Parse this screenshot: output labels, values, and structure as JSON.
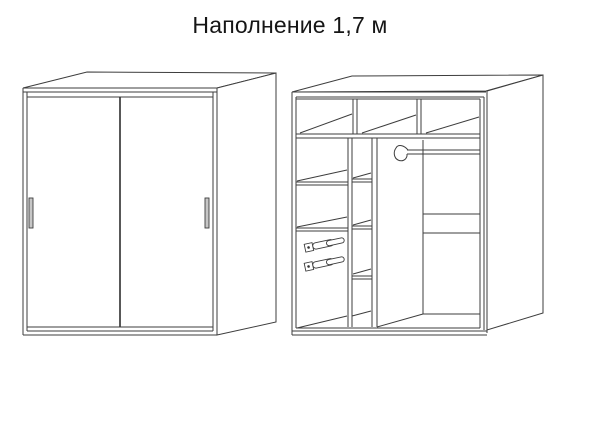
{
  "page": {
    "background": "#ffffff",
    "line_color": "#3d3d3d",
    "width": 600,
    "height": 422
  },
  "title": {
    "text": "Наполнение 1,7 м"
  },
  "diagram": {
    "type": "furniture-scheme",
    "views": [
      {
        "id": "closed-view",
        "name": "wardrobe-closed-view",
        "parts": [
          "top-panel",
          "right-side-panel",
          "left-sliding-door",
          "right-sliding-door",
          "left-door-handle",
          "right-door-handle",
          "base-panel"
        ]
      },
      {
        "id": "interior-view",
        "name": "wardrobe-interior-view",
        "parts": [
          "top-panel",
          "right-side-panel",
          "upper-shelf-three-compartments",
          "left-shelf-column",
          "middle-shelf-column",
          "drawer-slide-upper",
          "drawer-slide-lower",
          "tall-partition",
          "hanging-rod",
          "hanging-rod-hook",
          "back-wall-shelf-lines",
          "base-panel"
        ]
      }
    ]
  }
}
